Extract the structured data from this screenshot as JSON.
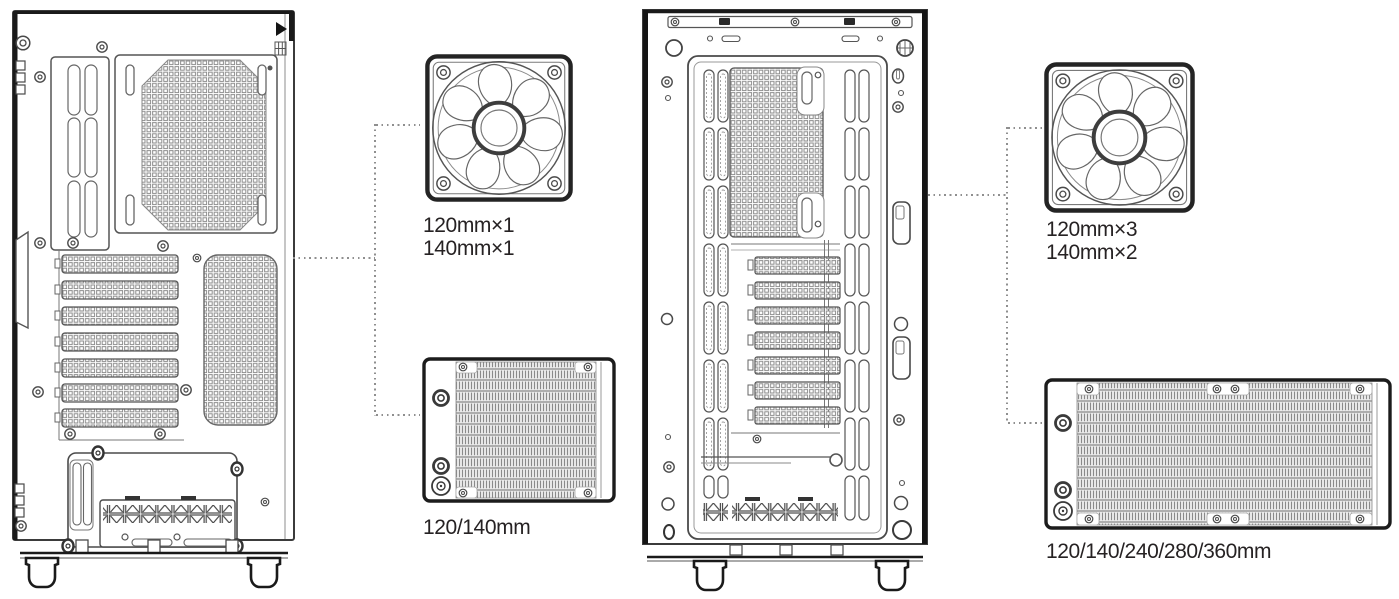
{
  "colors": {
    "background": "#ffffff",
    "line": "#3b3b3b",
    "line_heavy": "#1a1a1a",
    "mesh_gray": "#8d8d8d",
    "fin_fill": "#ececec",
    "connector_dot": "#8f8f8f",
    "text": "#262223"
  },
  "rear_view": {
    "fan": {
      "label_line1": "120mm×1",
      "label_line2": "140mm×1"
    },
    "radiator": {
      "label": "120/140mm"
    }
  },
  "front_view": {
    "fan": {
      "label_line1": "120mm×3",
      "label_line2": "140mm×2"
    },
    "radiator": {
      "label": "120/140/240/280/360mm"
    }
  }
}
